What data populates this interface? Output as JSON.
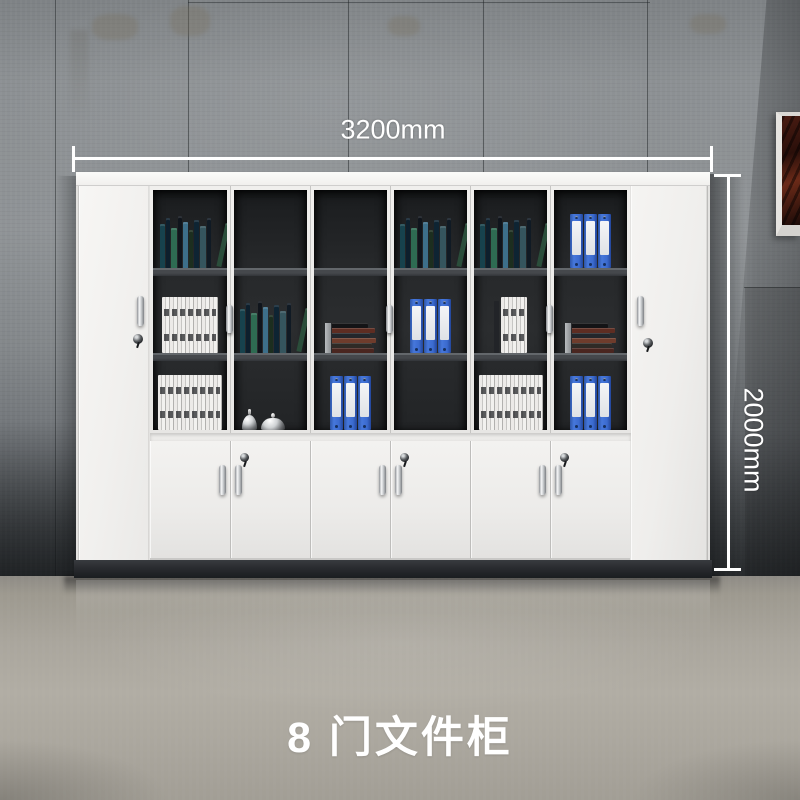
{
  "annotations": {
    "width_label": "3200mm",
    "height_label": "2000mm",
    "caption": "8 门文件柜"
  },
  "colors": {
    "dim-white": "#ffffff",
    "caption-white": "#ffffff",
    "binder-blue": "#3f6fd2",
    "cabinet-white": "#f2f1ef",
    "plinth-dark": "#26282c",
    "wall-gray": "#8d9194",
    "floor-gray": "#aaa69e",
    "glass-interior": "#232527",
    "artwork-red": "#5a2315"
  },
  "cabinet": {
    "tall_door_count": 2,
    "glass_door_count": 6,
    "bottom_door_count": 6,
    "glass_sections": [
      {
        "top": "books-colorful",
        "middle": "books-white-stack",
        "bottom": "books-white-stack-wide"
      },
      {
        "top": "bird-sculpture",
        "middle": "books-colorful",
        "bottom": "bells"
      },
      {
        "top": "horse-sculpture",
        "middle": "books-horizontal",
        "bottom": "binders-blue"
      },
      {
        "top": "books-colorful",
        "middle": "binders-blue",
        "bottom": "saturn-decor"
      },
      {
        "top": "books-colorful",
        "middle": "books-white-stack-small",
        "bottom": "books-white-stack-wide"
      },
      {
        "top": "binders-blue",
        "middle": "books-horizontal",
        "bottom": "binders-blue"
      }
    ]
  }
}
